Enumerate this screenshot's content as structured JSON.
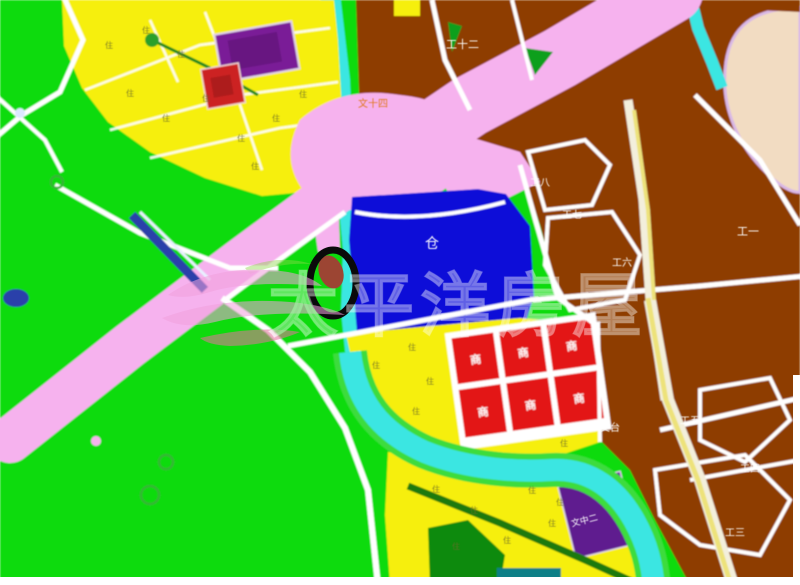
{
  "map": {
    "type": "urban-planning-zoning-map",
    "marker": "black-ellipse-site-highlight"
  },
  "watermark": {
    "brand": "太平洋房屋",
    "logo": "pacific-waves-logo"
  },
  "chars": {
    "residential": "住",
    "commercial": "商",
    "warehouse": "仓"
  },
  "zone_labels": {
    "industrial_12": "工十二",
    "parcel_top": "文十四",
    "industrial_1": "工一",
    "industrial_8": "工八",
    "industrial_7": "工七",
    "industrial_6": "工六",
    "industrial_5": "工五",
    "industrial_4": "工四",
    "industrial_3": "工三",
    "wentai": "文台",
    "school_south": "文中二"
  },
  "colors": {
    "greenbelt": "#0bdb0b",
    "residential_yellow": "#f6ef0a",
    "industrial_brown": "#8e3c03",
    "road_pink": "#f6b2ee",
    "river_cyan": "#3ae6e2",
    "warehouse_blue": "#0b0bd8",
    "commercial_red": "#e31212",
    "civic_purple": "#7a1d97",
    "outside_beige": "#f2dcc2"
  }
}
